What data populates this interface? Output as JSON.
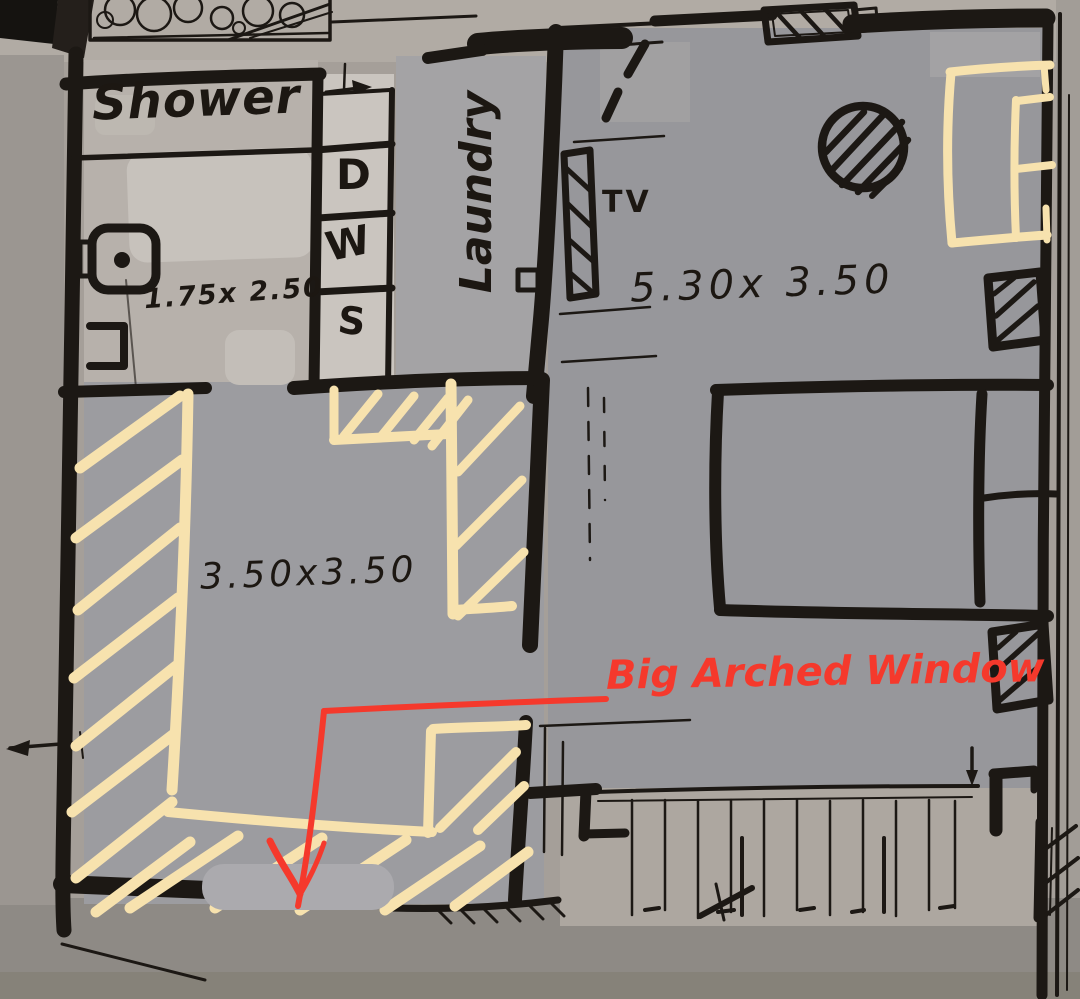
{
  "floor_plan": {
    "labels": {
      "shower": "Shower",
      "laundry": "Laundry",
      "tv": "TV",
      "appliance_d": "D",
      "appliance_w": "W",
      "appliance_s": "S"
    },
    "dimensions": {
      "shower_room": "1.75x 2.50",
      "bedroom": "5.30x 3.50",
      "living_room": "3.50x3.50"
    },
    "annotations": {
      "big_arched_window": "Big Arched Window"
    },
    "colors": {
      "ink_black": "#1c1814",
      "highlight_cream": "#f7e2ae",
      "annotation_red": "#f5392c",
      "paper_gray": "#a59f99",
      "room_fill_gray": "#97979b"
    }
  }
}
